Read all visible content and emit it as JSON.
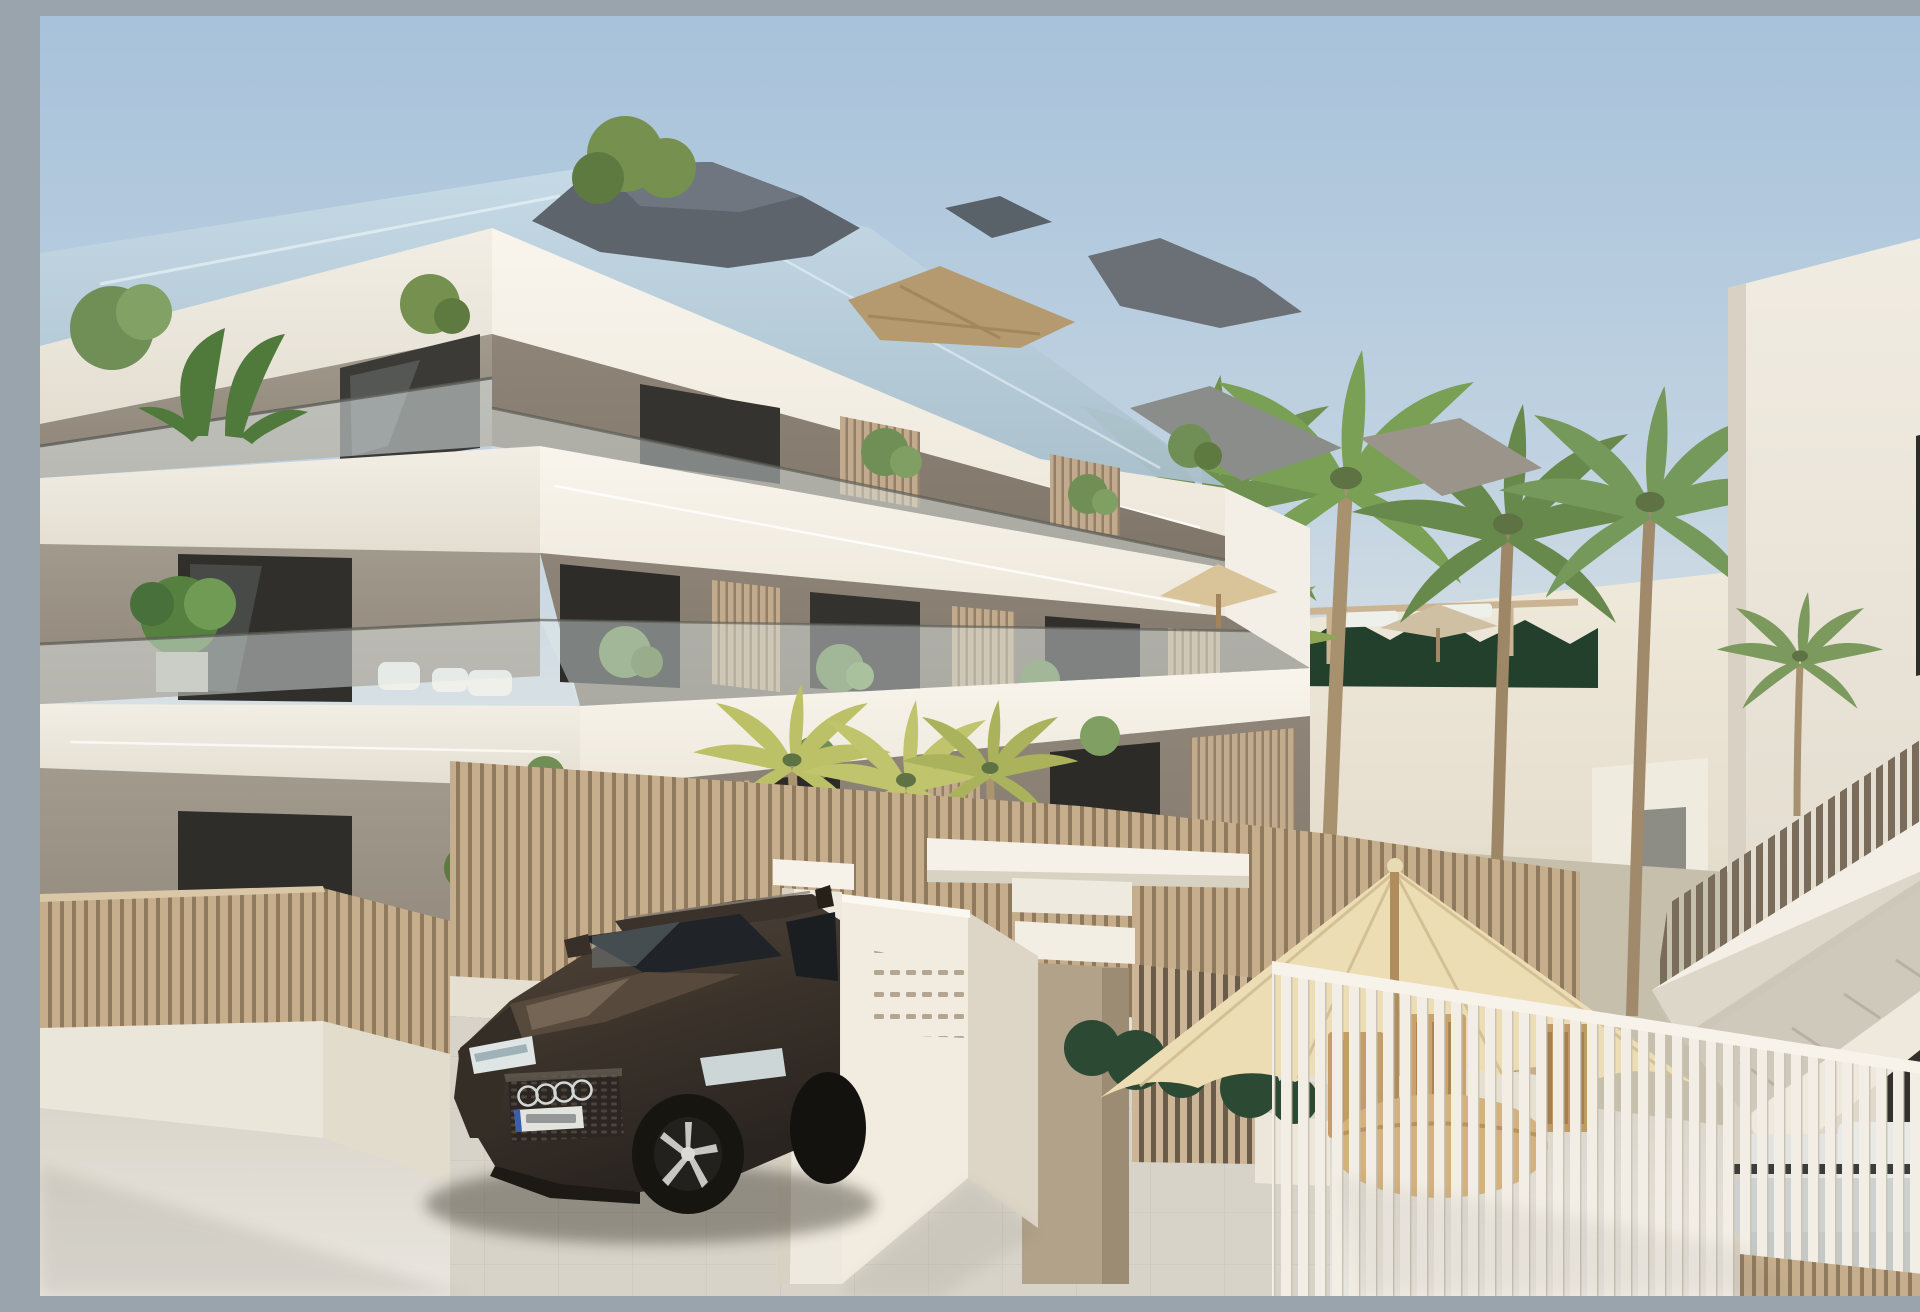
{
  "meta": {
    "type": "architectural-exterior-render",
    "alt": "Photorealistic render of a new-build three-storey apartment complex with cream slab bands, taupe walls, glass balustrades and beige slatted privacy screens. A dark bronze SUV is parked at the entrance gate beside a white mailbox wall. Beige slat fences enclose a communal garden with tall palm trees, a dark hedge, sun loungers and parasols. A neighbouring white block with an external staircase and a grey outdoor sofa stands at the right. A private terrace with a cream parasol and a wooden dining set sits behind a white picket fence in the foreground."
  },
  "palette": {
    "sky_top": "#a7c2da",
    "sky_mid": "#c3d4e2",
    "sky_horizon": "#e7eae6",
    "glass_roof": "#b9d0dc",
    "facade_white": "#f6f2e9",
    "facade_white_shade": "#e9e4d8",
    "wall_taupe": "#948b7f",
    "wall_taupe_light": "#a49b8f",
    "window_dark": "#2f2e2b",
    "fence_beige": "#c6ae8d",
    "fence_gap": "#8f7a5e",
    "fence_white": "#f2eee5",
    "hedge_green": "#23402c",
    "palm_green": "#6e9150",
    "palm_yellow": "#bcc168",
    "trunk_brown": "#a08a6b",
    "umbrella_cream": "#ecddb4",
    "car_body_dark": "#2a2420",
    "car_body_light": "#55483c",
    "car_glass": "#202327",
    "ground_light": "#e9e6df",
    "ground_dark": "#c9c5bb",
    "right_building": "#f1ece2"
  },
  "objects": {
    "main_building": {
      "label": "apartment building",
      "floors": 3,
      "balcony_screens": "beige vertical slats",
      "balustrades": "frameless glass"
    },
    "car": {
      "label": "dark bronze SUV",
      "badge": "four interlocked rings",
      "plate": "illegible euro plate"
    },
    "gate": {
      "label": "entrance gate with mailbox wall",
      "mail_slot_rows": 4,
      "mail_slot_cols": 6
    },
    "garden": {
      "label": "communal palm garden with pool loungers",
      "palm_count": 10,
      "loungers": 4
    },
    "patio": {
      "label": "private terrace with parasol and wooden dining set",
      "chairs": 3
    },
    "right_building": {
      "label": "neighbouring block with external staircase and grey sofa"
    }
  }
}
